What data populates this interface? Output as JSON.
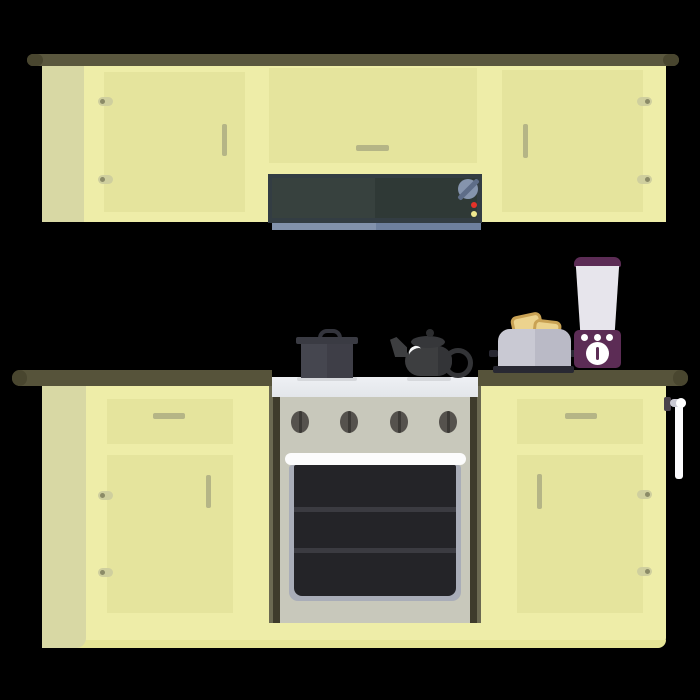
{
  "scene": {
    "description": "flat-style kitchen illustration on black background",
    "objects": [
      {
        "id": "upper-cabinets",
        "label": "wall cabinets with three doors"
      },
      {
        "id": "microwave",
        "label": "built-in microwave with dial and two indicator dots"
      },
      {
        "id": "counter",
        "label": "dark olive countertop"
      },
      {
        "id": "lower-cabinets",
        "label": "base cabinets with drawers and doors"
      },
      {
        "id": "stove-oven",
        "label": "range with four knobs and oven window with two racks"
      },
      {
        "id": "cooking-pot",
        "label": "dark pot with lid on stovetop"
      },
      {
        "id": "teapot",
        "label": "black teapot on stovetop"
      },
      {
        "id": "toaster",
        "label": "gray toaster with two toast slices"
      },
      {
        "id": "blender",
        "label": "purple blender with white jar and dial"
      },
      {
        "id": "paper-towel-holder",
        "label": "towel holder on right cabinet side"
      }
    ]
  },
  "palette": {
    "bg": "#000000",
    "trim": "#5a573e",
    "trim_cap": "#49462f",
    "cabinet_door": "#eeeda8",
    "cabinet_side": "#d8d8a4",
    "cabinet_inset": "#e5e49d",
    "cabinet_bottom": "#e6e596",
    "handle": "#b5b586",
    "hinge": "#cfcf9e",
    "hinge_dot": "#8b8b67",
    "microwave_frame": "#333d43",
    "microwave_door_left": "#37413e",
    "microwave_door_right": "#2f3936",
    "microwave_dial": "#8594ad",
    "microwave_dial_stripe": "#5e6d88",
    "microwave_bar_left": "#8292ac",
    "microwave_bar_right": "#6e809e",
    "dot_red": "#e53229",
    "dot_yellow": "#efe88f",
    "counter": "#56533a",
    "stove_top": "#e3e6ea",
    "stove_body": "#c8c8bb",
    "stove_strip_dark": "#3e3b2b",
    "stove_strip_light": "#6b6951",
    "knob": "#55524d",
    "knob_slit": "#3b3935",
    "oven_handle": "#fcfcfc",
    "oven_frame": "#a9adb8",
    "oven_interior": "#242428",
    "oven_rack": "#3b3b41",
    "pot_body_left": "#45464f",
    "pot_body_right": "#3e3e47",
    "pot_lid": "#3a3b43",
    "pot_knob": "#33343c",
    "teapot_body": "#3d3e40",
    "teapot_dark": "#333437",
    "teapot_lid": "#36373a",
    "teapot_knob": "#2c2d2f",
    "highlight_white": "#f5f6f7",
    "shadow_gray": "#d6d8dc",
    "toaster_left": "#c9c9d3",
    "toaster_right": "#babac6",
    "toaster_base": "#282832",
    "toast": "#ecd38e",
    "toast_crust": "#c9a254",
    "blender_purple": "#5c2c55",
    "blender_jar": "#e7e5ec",
    "towel_bracket": "#49414b",
    "towel_bar": "#c9c9d3",
    "towel": "#fbfbfd",
    "white": "#ffffff"
  }
}
